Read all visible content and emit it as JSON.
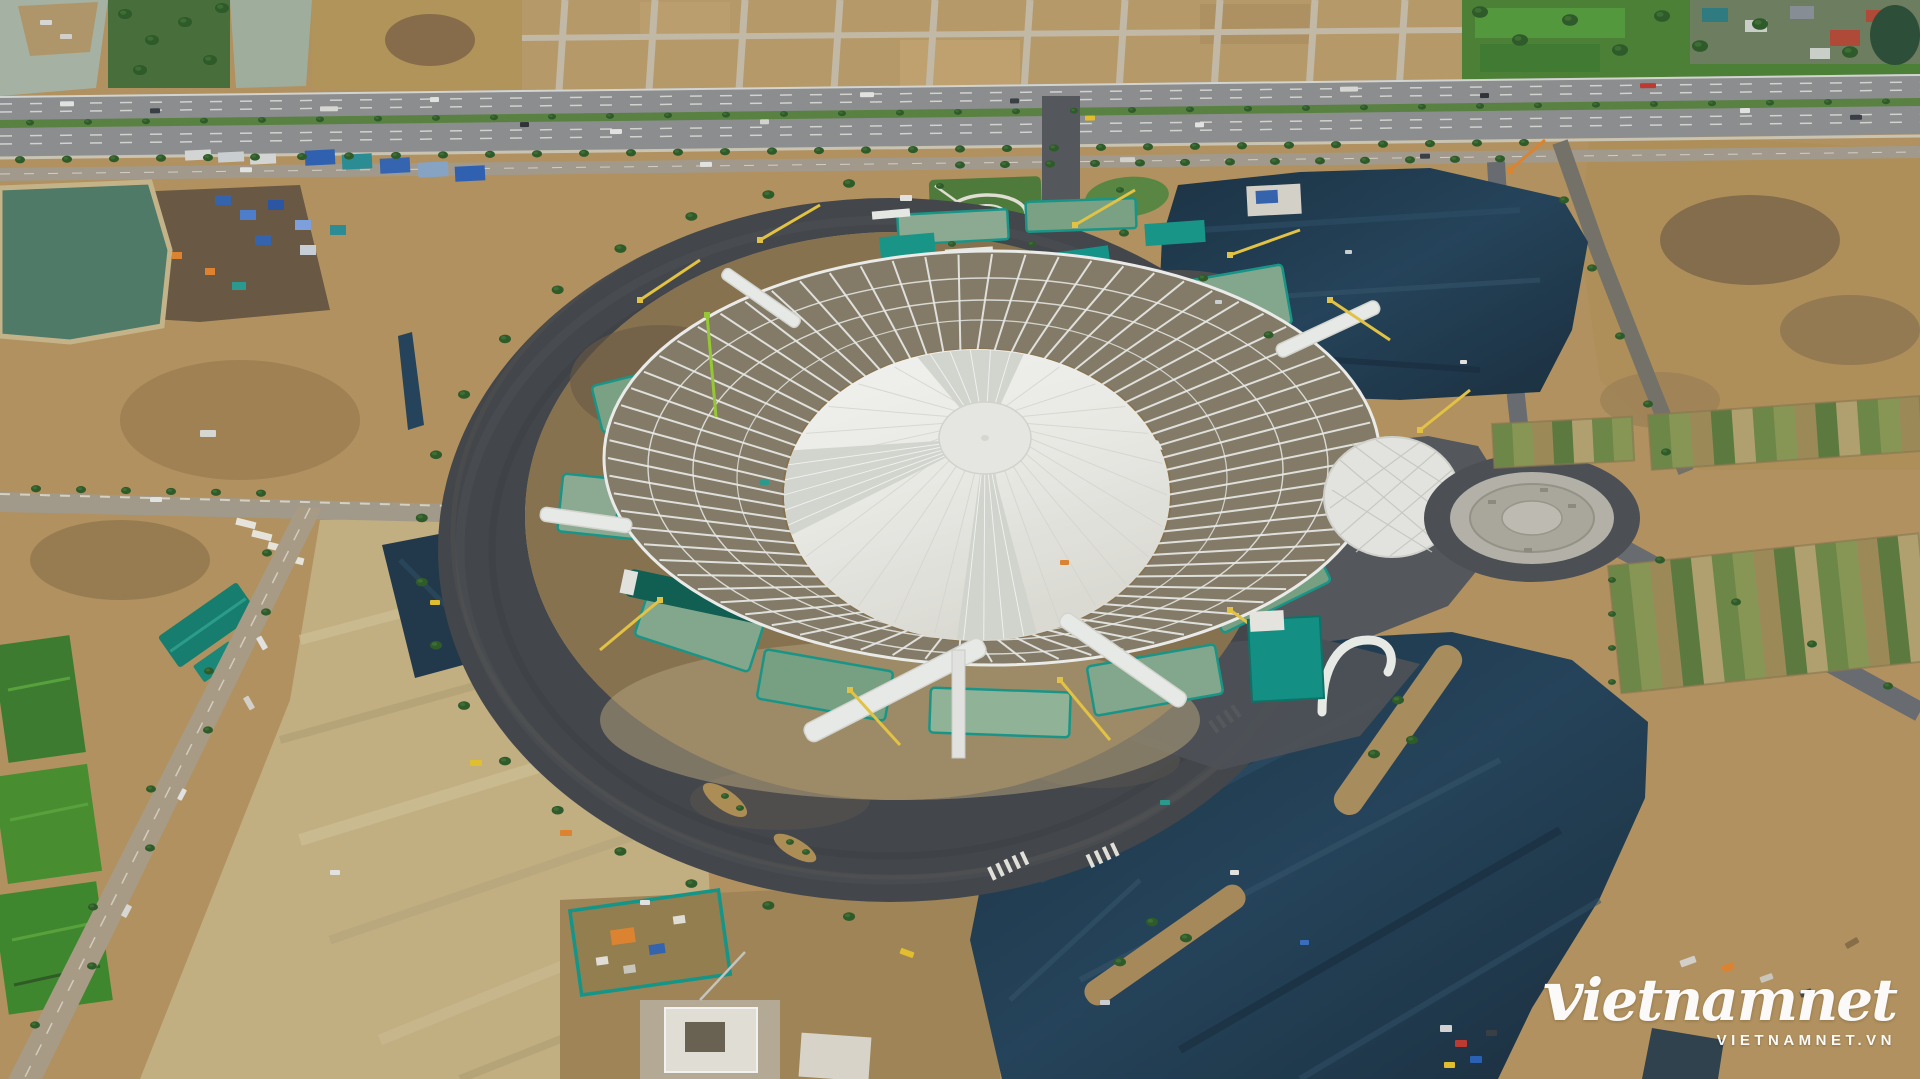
{
  "watermark": {
    "logo": "vietnamnet",
    "url": "VIETNAMNET.VN"
  },
  "scene": {
    "alt": "Aerial drone photo of a giant circular exhibition dome under construction: white membrane roof and radial steel trusses, surrounded by a dark ring road, bare earth lots, teal construction platforms, cranes, a highway at top and large freshly-paved dark parking areas"
  },
  "palette": {
    "ground": "#b6945f",
    "ground_pale": "#c6b384",
    "ground_dark": "#8f7347",
    "soil": "#6a5943",
    "asphalt_ring": "#43464a",
    "asphalt_mid": "#55585c",
    "paved_dark": "#20394a",
    "road_light": "#a59d8b",
    "highway": "#8e9090",
    "median_green": "#5a8440",
    "field_green": "#4c8336",
    "tree_green": "#2e5b28",
    "water_pale": "#a9b6a5",
    "water_teal": "#4f7c68",
    "membrane": "#f1f1ed",
    "truss_white": "#eef0ec",
    "truss_ground": "#867d68",
    "platform_green": "#84aa8c",
    "fence_teal": "#14968a",
    "roof_teal": "#157f6f",
    "tarp_blue": "#3565b0",
    "crane_yellow": "#e8c743",
    "machine_orange": "#e2862f",
    "white": "#ffffff"
  }
}
